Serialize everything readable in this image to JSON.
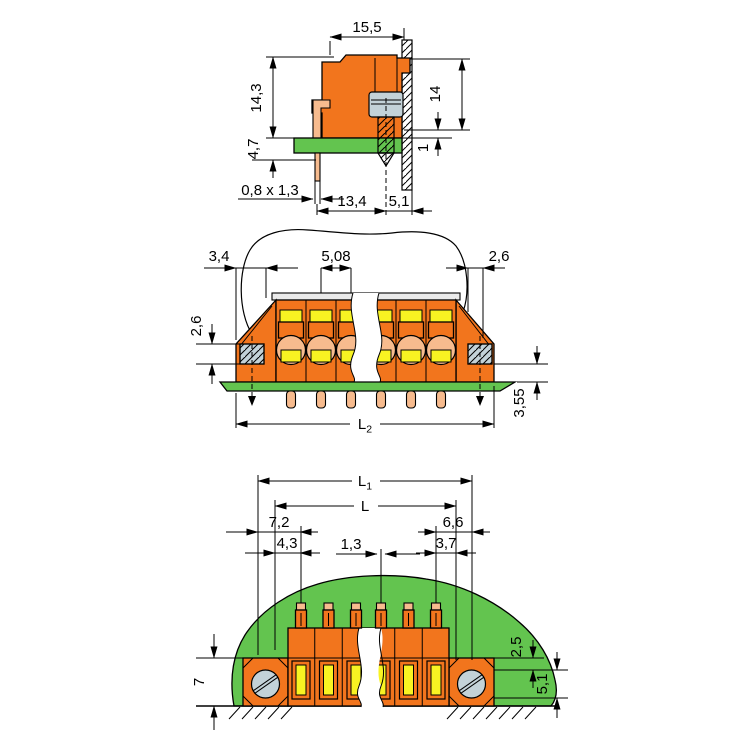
{
  "dimensions": {
    "side": {
      "overall_width": "15,5",
      "height_above_board": "14,3",
      "pin_protrusion": "4,7",
      "pin_section": "0,8 x 1,3",
      "pin_to_screw": "13,4",
      "screw_to_panel": "5,1",
      "panel_height": "14",
      "board_clearance": "1"
    },
    "front": {
      "left_offset": "3,4",
      "pitch": "5,08",
      "right_offset": "2,6",
      "screw_size": "2,6",
      "board_standoff": "3,55",
      "length2_main": "L",
      "length2_sub": "2"
    },
    "mounting": {
      "length1_main": "L",
      "length1_sub": "1",
      "length_main": "L",
      "left_edge": "7,2",
      "right_edge": "6,6",
      "left_hole": "4,3",
      "right_hole": "3,7",
      "pin_width": "1,3",
      "flange_height": "7",
      "screw_top_offset": "2,5",
      "screw_height": "5,1"
    }
  },
  "colors": {
    "housing_orange": "#F2751D",
    "pcb_green": "#63C44F",
    "pin_copper": "#F7BB8E",
    "screw_grey": "#C3D2D8",
    "contact_yellow": "#F8F322",
    "rim_grey": "#EAEAEA",
    "outline": "#000000"
  }
}
